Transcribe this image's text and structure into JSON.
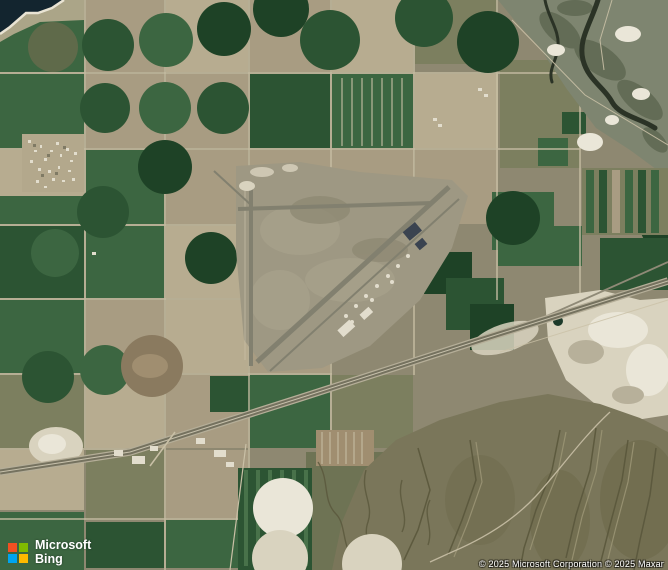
{
  "logo": {
    "brand_top": "Microsoft",
    "brand_bottom": "Bing"
  },
  "copyright": {
    "text": "© 2025 Microsoft Corporation © 2025 Maxar"
  },
  "icons": {
    "logo_icon": "microsoft-four-squares"
  },
  "colors": {
    "water": "#13252f",
    "shore": "#e9e4d4",
    "land": "#8e8871",
    "road": "#c9c0a6",
    "green1": "#1e4226",
    "green2": "#2c5433",
    "green3": "#3c6641",
    "green4": "#5c8a5c",
    "olive": "#7c7f5f",
    "olive2": "#6e7354",
    "olivecirc": "#5f6a4a",
    "tan": "#a89c82",
    "tan2": "#b7ac90",
    "brown": "#8a7a5f",
    "brown2": "#a08e70",
    "airport": "#9e9883",
    "runway": "#82806f",
    "highway": "#75725f",
    "hwedge": "#b5ae98",
    "rail": "#8f8a77",
    "sand": "#d9d3bf",
    "sand2": "#eae6d8",
    "mountain": "#7a765a",
    "ridged": "#5a573c",
    "ridgel": "#9a9474",
    "ravine": "#2b3326",
    "terrain": "#7e8570",
    "terraind": "#5d6650",
    "white": "#e2ddcd",
    "hangar": "#3a4350",
    "town": "#b3a88c",
    "pond": "#1c3a2a",
    "ms-red": "#f25022",
    "ms-green": "#7fba00",
    "ms-blue": "#00a4ef",
    "ms-yellow": "#ffb900",
    "logo-text": "#ffffff"
  }
}
